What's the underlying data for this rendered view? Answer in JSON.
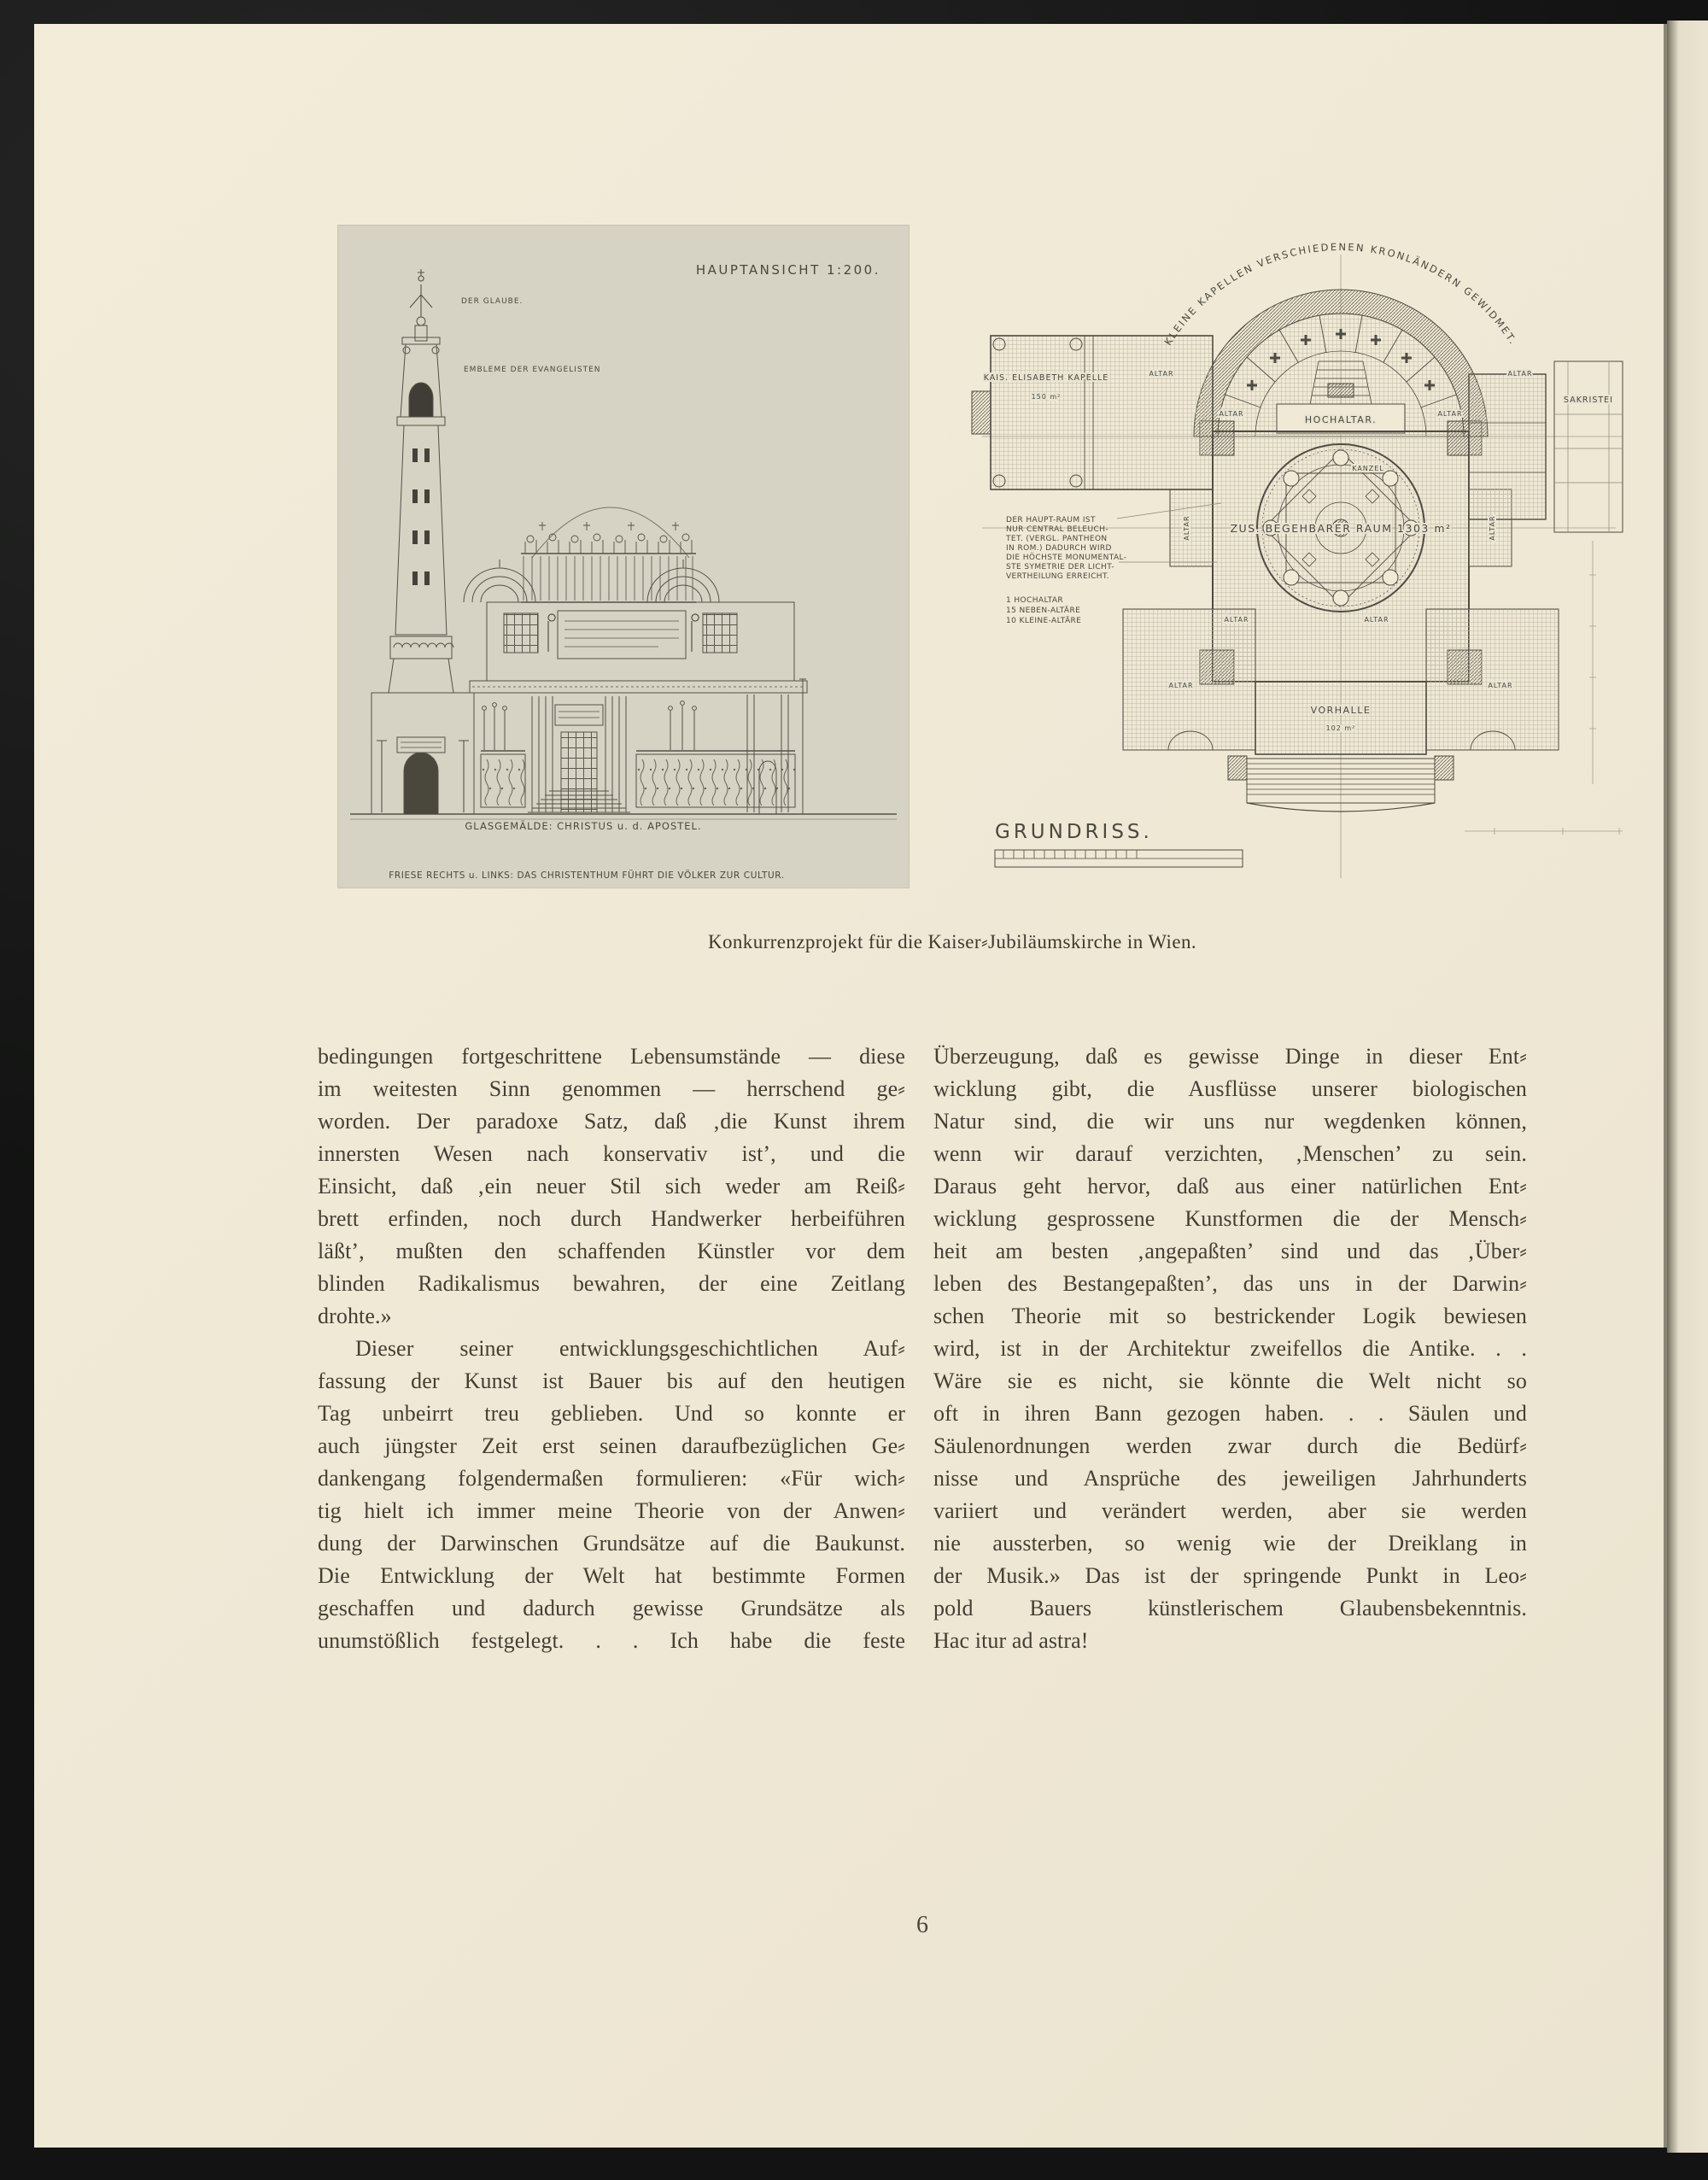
{
  "page": {
    "number": "6"
  },
  "caption": "Konkurrenzprojekt für die Kaiser⸗Jubiläumskirche in Wien.",
  "article": {
    "left_para1_lines": [
      "bedingungen fortgeschrittene Lebensumstände — diese",
      "im weitesten Sinn genommen — herrschend ge⸗",
      "worden. Der paradoxe Satz, daß ‚die Kunst ihrem",
      "innersten Wesen nach konservativ ist’, und die",
      "Einsicht, daß ‚ein neuer Stil sich weder am Reiß⸗",
      "brett erfinden, noch durch Handwerker herbeiführen",
      "läßt’, mußten den schaffenden Künstler vor dem",
      "blinden Radikalismus bewahren, der eine Zeitlang",
      "drohte.»"
    ],
    "left_para2_lines": [
      "Dieser seiner entwicklungsgeschichtlichen Auf⸗",
      "fassung der Kunst ist Bauer bis auf den heutigen",
      "Tag unbeirrt treu geblieben.  Und so konnte er",
      "auch jüngster Zeit erst seinen daraufbezüglichen Ge⸗",
      "dankengang folgendermaßen formulieren: «Für wich⸗",
      "tig hielt ich immer meine Theorie von der Anwen⸗",
      "dung der Darwinschen Grundsätze auf die Baukunst.",
      "Die Entwicklung der Welt hat bestimmte Formen",
      "geschaffen und dadurch gewisse Grundsätze als",
      "unumstößlich festgelegt. . .  Ich habe die feste"
    ],
    "right_para_lines": [
      "Überzeugung, daß es gewisse Dinge in dieser Ent⸗",
      "wicklung gibt, die Ausflüsse unserer biologischen",
      "Natur sind, die wir uns nur wegdenken können,",
      "wenn wir darauf verzichten, ‚Menschen’ zu sein.",
      "Daraus geht hervor, daß aus einer natürlichen Ent⸗",
      "wicklung gesprossene Kunstformen die der Mensch⸗",
      "heit am besten ‚angepaßten’ sind und das ‚Über⸗",
      "leben des Bestangepaßten’, das uns in der Darwin⸗",
      "schen Theorie mit so bestrickender Logik bewiesen",
      "wird, ist in der Architektur zweifellos die Antike. . .",
      "Wäre sie es nicht, sie könnte die Welt nicht so",
      "oft in ihren Bann gezogen haben. . .  Säulen und",
      "Säulenordnungen werden zwar durch die Bedürf⸗",
      "nisse und Ansprüche des jeweiligen Jahrhunderts",
      "variiert und verändert werden, aber sie werden",
      "nie aussterben, so wenig wie der Dreiklang in",
      "der Musik.» Das ist der springende Punkt in Leo⸗",
      "pold Bauers künstlerischem Glaubensbekenntnis.",
      "Hac itur ad astra!"
    ]
  },
  "elevation": {
    "title": "HAUPTANSICHT 1:200.",
    "note_statue": "DER GLAUBE.",
    "note_evangelists": "EMBLEME DER EVANGELISTEN",
    "caption_glass": "GLASGEMÄLDE: CHRISTUS u. d. APOSTEL.",
    "caption_frieze": "FRIESE RECHTS u. LINKS: DAS CHRISTENTHUM FÜHRT DIE VÖLKER ZUR CULTUR."
  },
  "plan": {
    "title": "GRUNDRISS.",
    "arc_label": "KLEINE KAPELLEN VERSCHIEDENEN KRONLÄNDERN GEWIDMET.",
    "chapel_label": "KAIS. ELISABETH KAPELLE",
    "chapel_area": "150 m²",
    "hochaltar_label": "HOCHALTAR.",
    "altar_label": "ALTAR",
    "kanzel_label": "KANZEL",
    "sakristei_label": "SAKRISTEI",
    "main_room_label": "ZUS. BEGEHBARER RAUM 1303 m²",
    "vorhalle_label": "VORHALLE",
    "vorhalle_area": "102 m²",
    "note_lines": [
      "DER HAUPT-RAUM IST",
      "NUR CENTRAL BELEUCH-",
      "TET. (VERGL. PANTHEON",
      "IN ROM.) DADURCH WIRD",
      "DIE HÖCHSTE MONUMENTAL-",
      "STE SYMETRIE DER LICHT-",
      "VERTHEILUNG ERREICHT."
    ],
    "altar_list_lines": [
      "1 HOCHALTAR",
      "15 NEBEN-ALTÄRE",
      "10 KLEINE-ALTÄRE"
    ]
  }
}
